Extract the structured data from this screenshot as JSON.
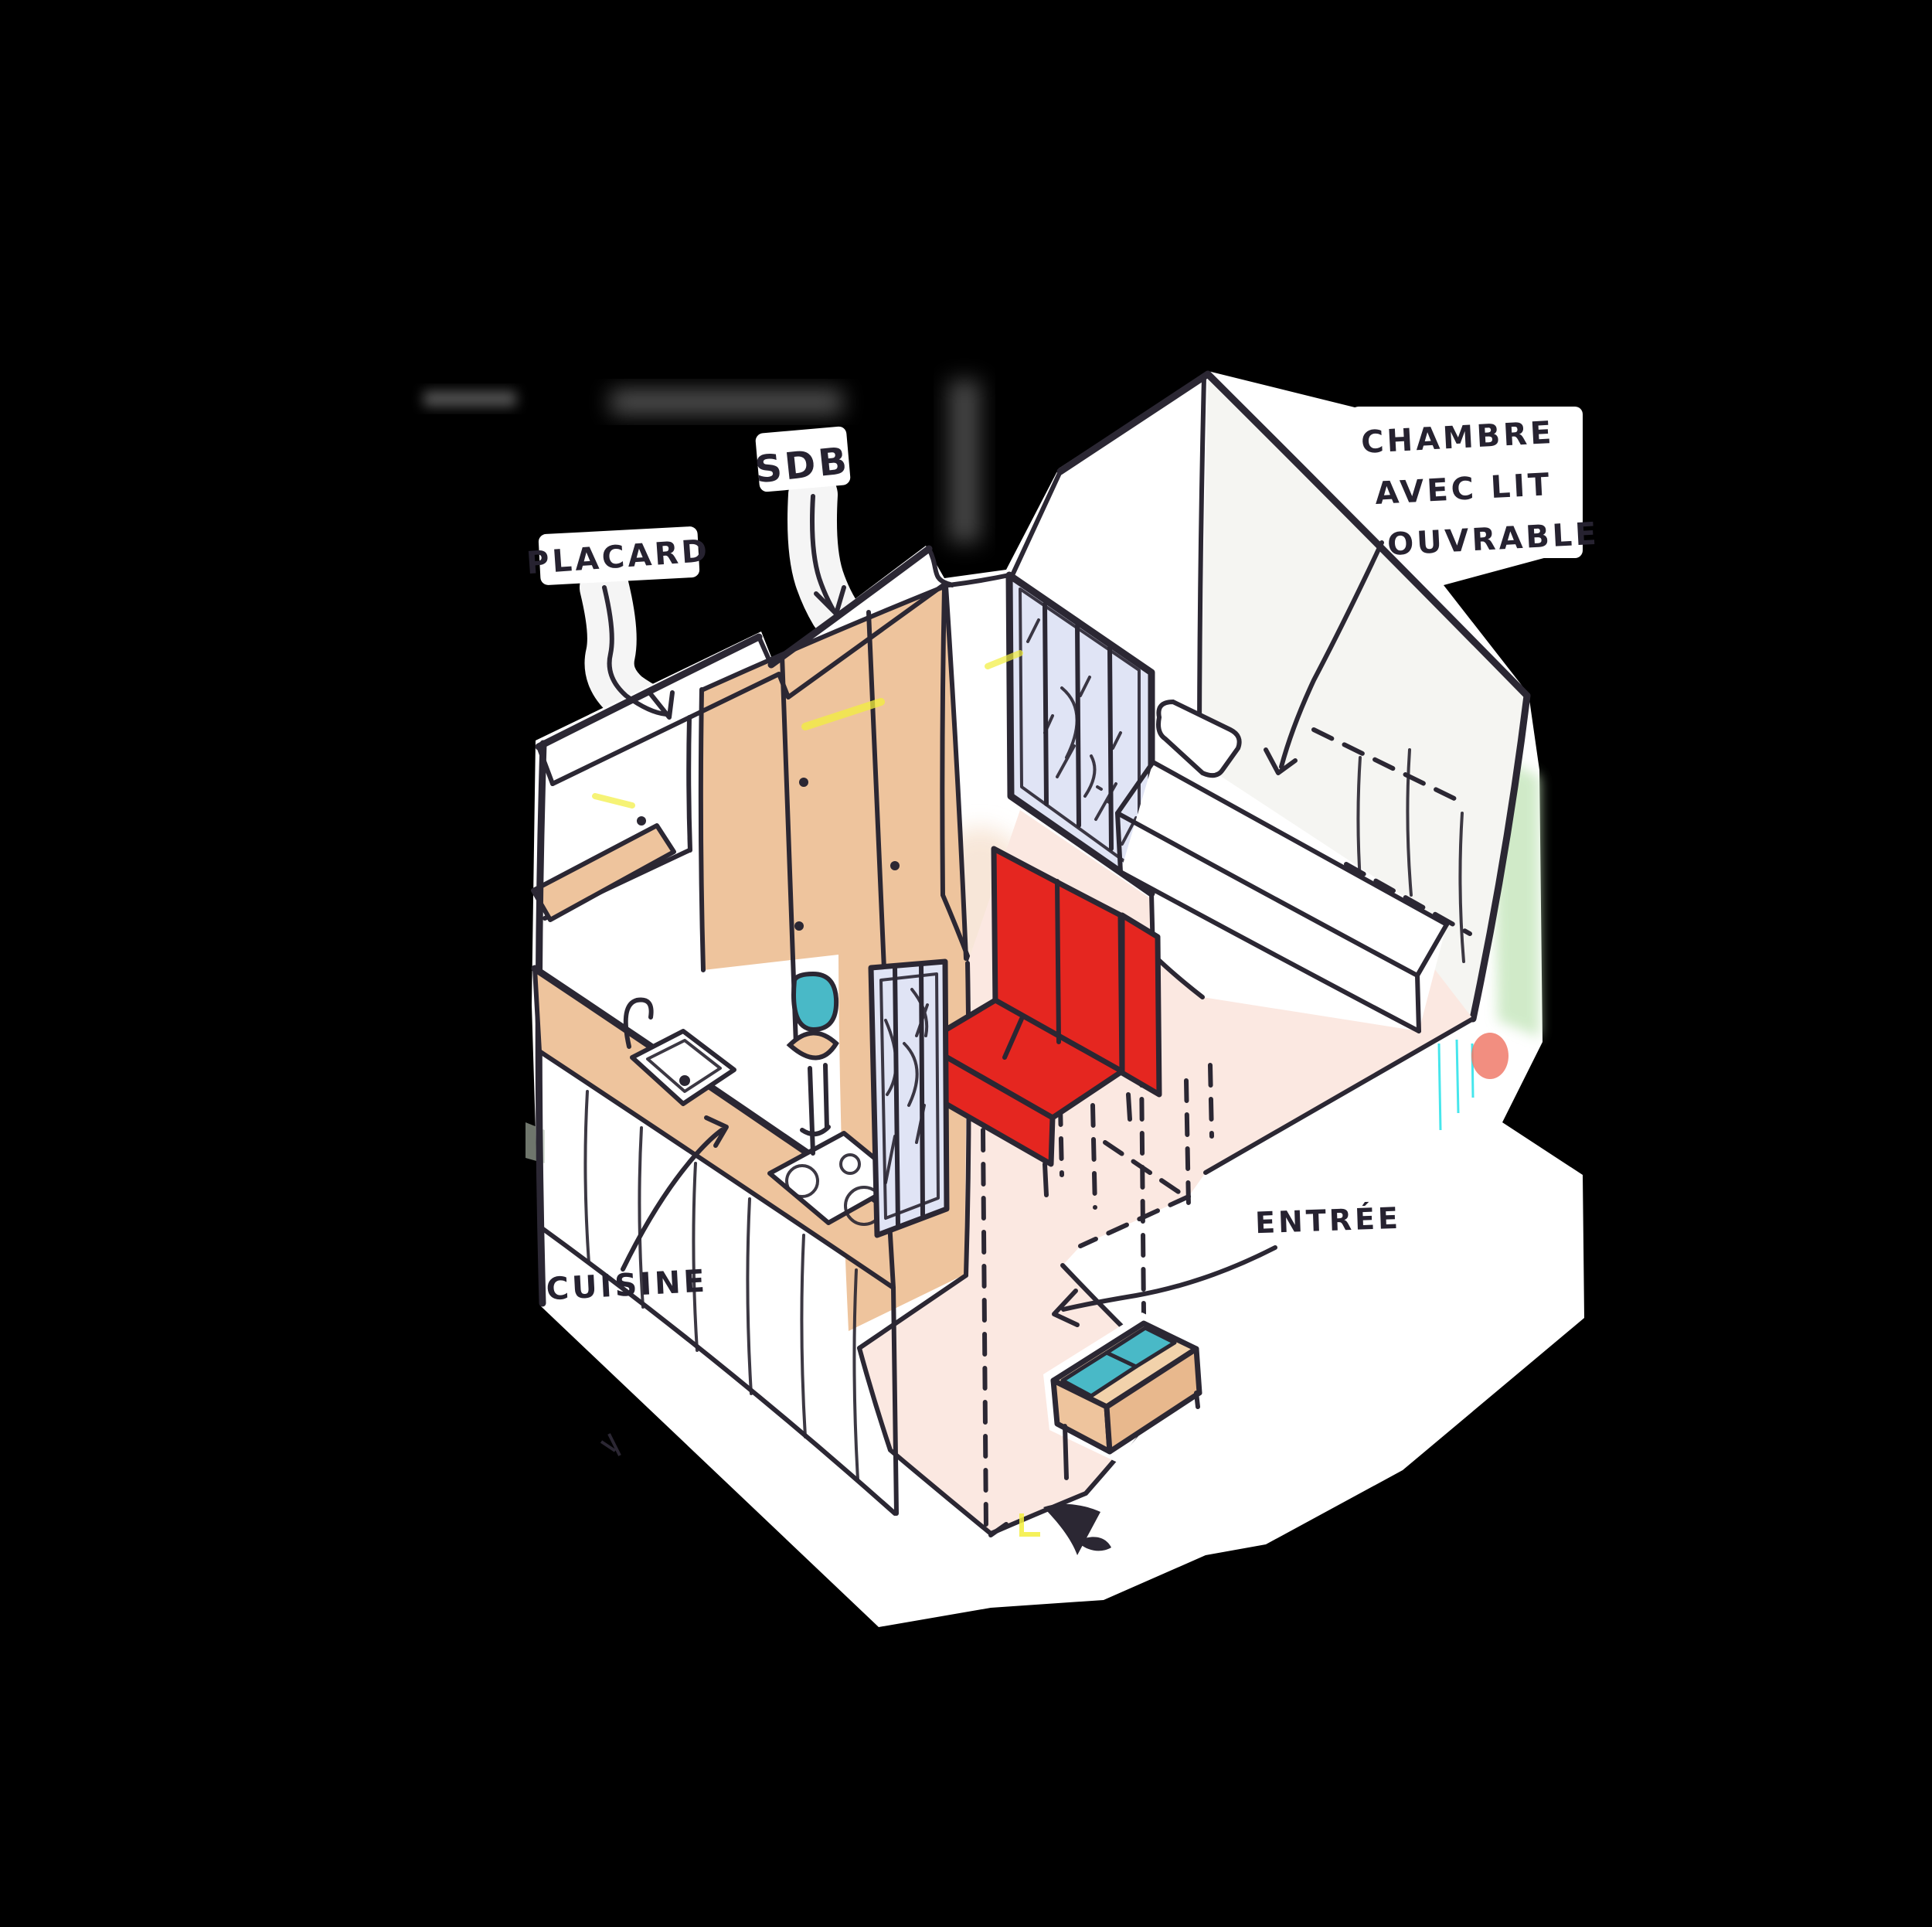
{
  "sketch": {
    "kind": "hand-drawn axonometric studio apartment plan",
    "labels": {
      "sdb": {
        "text": "SDB"
      },
      "placard": {
        "text": "PLACARD"
      },
      "cuisine": {
        "text": "CUISINE"
      },
      "entree": {
        "text": "ENTRÉE"
      },
      "chambre": {
        "line1": "CHAMBRE",
        "line2": "AVEC LIT",
        "line3": "OUVRABLE"
      }
    },
    "colors": {
      "background": "#000000",
      "paper": "#ffffff",
      "ink": "#2b2733",
      "floor_pink": "#fbe8e1",
      "wood_tan": "#eec49d",
      "wood_tan_light": "#f2d2ab",
      "sofa_red": "#e52620",
      "teal": "#49b9c7",
      "glass_lavender": "#e0e4f5",
      "highlight_yellow": "#f3ef3d",
      "tint_green": "#c8e7bf"
    }
  }
}
